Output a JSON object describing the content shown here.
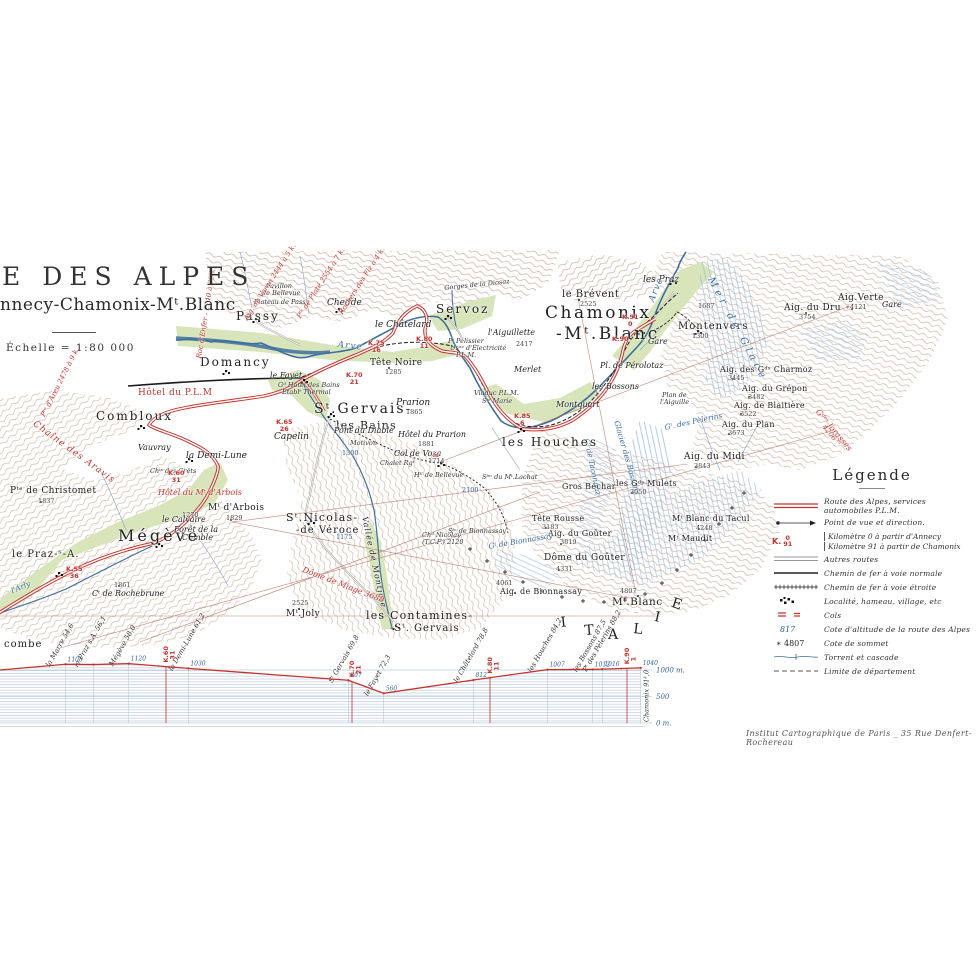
{
  "title": {
    "main": "E DES ALPES",
    "sub": "nnecy-Chamonix-Mᵗ.Blanc",
    "scale": "Échelle = 1:80 000"
  },
  "credit": "Institut Cartographique de Paris _ 35 Rue Denfert-Rochereau",
  "colors": {
    "route_red": "#c5332d",
    "water_blue": "#3f6f9f",
    "alt_blue": "#34629c",
    "terrain_brown": "#ad7a5c"
  },
  "legend": {
    "title": "Légende",
    "items": [
      {
        "sym": "route",
        "label": "Route des Alpes, services automobiles P.L.M."
      },
      {
        "sym": "view",
        "label": "Point de vue et direction."
      },
      {
        "sym": "km",
        "sym_top": "K.",
        "sym_num": "0",
        "sym_den": "91",
        "lines": [
          "Kilomètre 0 à partir d'Annecy",
          "Kilomètre 91 à partir de Chamonix"
        ]
      },
      {
        "sym": "road",
        "label": "Autres routes"
      },
      {
        "sym": "rail",
        "label": "Chemin de fer à voie normale"
      },
      {
        "sym": "railn",
        "label": "Chemin de fer à voie étroite"
      },
      {
        "sym": "loc",
        "label": "Localité, hameau, village, etc"
      },
      {
        "sym": "col",
        "label": "Cols"
      },
      {
        "sym": "alt",
        "sym_text": "817",
        "label": "Cote d'altitude de la route des Alpes"
      },
      {
        "sym": "summit",
        "sym_text": "4807",
        "label": "Cote de sommet"
      },
      {
        "sym": "torrent",
        "label": "Torrent et cascade"
      },
      {
        "sym": "limit",
        "label": "Limite de département"
      }
    ]
  },
  "chart_data": {
    "type": "line",
    "title": "",
    "ylabel": "m",
    "ylim": [
      0,
      1200
    ],
    "yticks": [
      {
        "label": "1000 m.",
        "value": 1000
      },
      {
        "label": "500",
        "value": 500
      },
      {
        "label": "0 m.",
        "value": 0
      }
    ],
    "stations": [
      {
        "name": "la Marre",
        "km_label": "54,6",
        "km": 54.6,
        "elev": 1108,
        "elev_label": "1108"
      },
      {
        "name": "le Praz s.A.",
        "km_label": "56,1",
        "km": 56.1,
        "elev": 1103,
        "elev_label": ""
      },
      {
        "name": "Mégève",
        "km_label": "58,0",
        "km": 58.0,
        "elev": 1120,
        "elev_label": "1120"
      },
      {
        "name": "la Demi-Lune",
        "km_label": "61,2",
        "km": 61.2,
        "elev": 1030,
        "elev_label": "1030"
      },
      {
        "name": "Sᵗ Gervais",
        "km_label": "69,8",
        "km": 69.8,
        "elev": 807,
        "elev_label": "807"
      },
      {
        "name": "le Fayet",
        "km_label": "72,3",
        "km": 72.3,
        "elev": 560,
        "elev_label": "560"
      },
      {
        "name": "le Châtelard",
        "km_label": "78,8",
        "km": 78.8,
        "elev": 812,
        "elev_label": "812"
      },
      {
        "name": "les Houches",
        "km_label": "84,2",
        "km": 84.2,
        "elev": 1007,
        "elev_label": "1007"
      },
      {
        "name": "les Bossons",
        "km_label": "87,5",
        "km": 87.5,
        "elev": 1012,
        "elev_label": "1012"
      },
      {
        "name": "Pᵗ des Pèlerins",
        "km_label": "88,2",
        "km": 88.2,
        "elev": 1016,
        "elev_label": "1016"
      },
      {
        "name": "Chamonix",
        "km_label": "91,0",
        "km": 91.0,
        "elev": 1040,
        "elev_label": "1040",
        "name_hidden": true
      }
    ],
    "km_markers": [
      {
        "label": "K.60",
        "sub": "31",
        "km": 60
      },
      {
        "label": "K.70",
        "sub": "21",
        "km": 70
      },
      {
        "label": "K.80",
        "sub": "11",
        "km": 80
      },
      {
        "label": "K.90",
        "sub": "1",
        "km": 90
      }
    ],
    "end_label": "Chamonix 91ᵏ,0"
  },
  "map": {
    "labels": [
      {
        "t": "Passy",
        "x": 236,
        "y": 310,
        "c": "town"
      },
      {
        "t": "Chedde",
        "x": 327,
        "y": 299,
        "c": "ham"
      },
      {
        "t": "le Châtelard",
        "x": 375,
        "y": 321,
        "c": "ham"
      },
      {
        "t": "Servoz",
        "x": 436,
        "y": 303,
        "c": "town"
      },
      {
        "t": "Tête Noire",
        "x": 370,
        "y": 359,
        "c": "peak9"
      },
      {
        "t": "1285",
        "x": 385,
        "y": 369,
        "c": "elev"
      },
      {
        "t": "le Brévent",
        "x": 562,
        "y": 290,
        "c": "peak10"
      },
      {
        "t": "2525",
        "x": 580,
        "y": 301,
        "c": "elev"
      },
      {
        "t": "Chamonix",
        "x": 545,
        "y": 305,
        "c": "town-xl"
      },
      {
        "t": "-Mᵗ.Blanc",
        "x": 556,
        "y": 326,
        "c": "town-xl"
      },
      {
        "t": "les Praz",
        "x": 643,
        "y": 276,
        "c": "ham"
      },
      {
        "t": "Gare",
        "x": 648,
        "y": 338,
        "c": "ham8"
      },
      {
        "t": "Montenvers",
        "x": 678,
        "y": 322,
        "c": "town10"
      },
      {
        "t": "1300",
        "x": 692,
        "y": 333,
        "c": "elev"
      },
      {
        "t": "1687",
        "x": 698,
        "y": 303,
        "c": "elev"
      },
      {
        "t": "Gare",
        "x": 882,
        "y": 301,
        "c": "ham8"
      },
      {
        "t": "Aig. du Dru",
        "x": 784,
        "y": 304,
        "c": "peak9"
      },
      {
        "t": "3754",
        "x": 799,
        "y": 314,
        "c": "elev"
      },
      {
        "t": "Aig.Verte",
        "x": 838,
        "y": 294,
        "c": "peak9"
      },
      {
        "t": "4121",
        "x": 850,
        "y": 304,
        "c": "elev"
      },
      {
        "t": "Mer de Glace",
        "x": 714,
        "y": 276,
        "c": "blue10",
        "r": 62
      },
      {
        "t": "Aig. des Gᵈˢ Charmoz",
        "x": 720,
        "y": 366,
        "c": "peak8"
      },
      {
        "t": "3445",
        "x": 728,
        "y": 375,
        "c": "elev"
      },
      {
        "t": "Aig. du Grépon",
        "x": 742,
        "y": 385,
        "c": "peak8"
      },
      {
        "t": "3482",
        "x": 748,
        "y": 394,
        "c": "elev"
      },
      {
        "t": "Aig. de Blaitière",
        "x": 734,
        "y": 402,
        "c": "peak8"
      },
      {
        "t": "3522",
        "x": 740,
        "y": 411,
        "c": "elev"
      },
      {
        "t": "Aig. du Plan",
        "x": 722,
        "y": 421,
        "c": "peak8"
      },
      {
        "t": "3673",
        "x": 728,
        "y": 430,
        "c": "elev"
      },
      {
        "t": "Aig. du Midi",
        "x": 684,
        "y": 453,
        "c": "peak9"
      },
      {
        "t": "3843",
        "x": 694,
        "y": 463,
        "c": "elev"
      },
      {
        "t": "Plan de",
        "x": 662,
        "y": 392,
        "c": "tiny"
      },
      {
        "t": "l'Aiguille",
        "x": 660,
        "y": 399,
        "c": "tiny"
      },
      {
        "t": "Gˡ. des Pèlerins",
        "x": 664,
        "y": 424,
        "c": "blue8",
        "r": -12
      },
      {
        "t": "Glacier des Bossons",
        "x": 620,
        "y": 420,
        "c": "blue8",
        "r": 74
      },
      {
        "t": "Gˡ de Taconnaz",
        "x": 590,
        "y": 438,
        "c": "blue8",
        "r": 78
      },
      {
        "t": "Gros Béchar",
        "x": 562,
        "y": 483,
        "c": "peak8"
      },
      {
        "t": "les Gᵈˢ Mulets",
        "x": 616,
        "y": 480,
        "c": "peak8"
      },
      {
        "t": "3050",
        "x": 630,
        "y": 489,
        "c": "elev"
      },
      {
        "t": "Tête Rousse",
        "x": 532,
        "y": 515,
        "c": "peak8"
      },
      {
        "t": "3183",
        "x": 542,
        "y": 524,
        "c": "elev"
      },
      {
        "t": "Aig. du Goûter",
        "x": 548,
        "y": 530,
        "c": "peak8"
      },
      {
        "t": "3819",
        "x": 560,
        "y": 539,
        "c": "elev"
      },
      {
        "t": "Mᵗ Blanc du Tacul",
        "x": 672,
        "y": 515,
        "c": "peak8"
      },
      {
        "t": "4248",
        "x": 696,
        "y": 525,
        "c": "elev"
      },
      {
        "t": "Mᵗ Maudit",
        "x": 668,
        "y": 535,
        "c": "peak8"
      },
      {
        "t": "Dôme du Goûter",
        "x": 544,
        "y": 554,
        "c": "peak9"
      },
      {
        "t": "4331",
        "x": 556,
        "y": 566,
        "c": "elev"
      },
      {
        "t": "4061",
        "x": 496,
        "y": 580,
        "c": "elev"
      },
      {
        "t": "Aig. de Bionnassay",
        "x": 500,
        "y": 588,
        "c": "peak8"
      },
      {
        "t": "Gˡ de Bionnassay",
        "x": 488,
        "y": 543,
        "c": "blue8",
        "r": -10
      },
      {
        "t": "4807",
        "x": 620,
        "y": 588,
        "c": "elev"
      },
      {
        "t": "Mᵗ.Blanc",
        "x": 612,
        "y": 597,
        "c": "peak11"
      },
      {
        "t": "Sᵗᵐ du Mᵗ.Lachat",
        "x": 482,
        "y": 474,
        "c": "tiny"
      },
      {
        "t": "2100",
        "x": 462,
        "y": 487,
        "c": "belev"
      },
      {
        "t": "Sᵗⁿ de Bionnassay",
        "x": 448,
        "y": 528,
        "c": "tiny"
      },
      {
        "t": "Chᵈ Nicolay",
        "x": 422,
        "y": 532,
        "c": "tiny"
      },
      {
        "t": "(T.C.F.) 2120",
        "x": 422,
        "y": 539,
        "c": "tiny"
      },
      {
        "t": "les Houches",
        "x": 502,
        "y": 436,
        "c": "town"
      },
      {
        "t": "Montquart",
        "x": 556,
        "y": 401,
        "c": "ham8"
      },
      {
        "t": "les Bossons",
        "x": 592,
        "y": 383,
        "c": "ham8"
      },
      {
        "t": "Pl. de Pérolotaz",
        "x": 600,
        "y": 362,
        "c": "ham8"
      },
      {
        "t": "Merlet",
        "x": 514,
        "y": 366,
        "c": "ham8"
      },
      {
        "t": "l'Aiguillette",
        "x": 488,
        "y": 329,
        "c": "ham8"
      },
      {
        "t": "2417",
        "x": 516,
        "y": 341,
        "c": "elev"
      },
      {
        "t": "Gorges de la Diosaz",
        "x": 444,
        "y": 285,
        "c": "tiny",
        "r": -6
      },
      {
        "t": "Pᵗ Pélissier",
        "x": 448,
        "y": 338,
        "c": "tiny"
      },
      {
        "t": "Usⁿᵉ d'Électricité",
        "x": 450,
        "y": 345,
        "c": "tiny"
      },
      {
        "t": "P.L.M.",
        "x": 456,
        "y": 352,
        "c": "tiny"
      },
      {
        "t": "Viaduc P.L.M.",
        "x": 474,
        "y": 390,
        "c": "tiny"
      },
      {
        "t": "Sᵗᵉ Marie",
        "x": 482,
        "y": 398,
        "c": "tiny"
      },
      {
        "t": "Plateau de Passy",
        "x": 254,
        "y": 299,
        "c": "tiny"
      },
      {
        "t": "Pavillon",
        "x": 266,
        "y": 283,
        "c": "tiny"
      },
      {
        "t": "de Bellevue",
        "x": 262,
        "y": 290,
        "c": "tiny"
      },
      {
        "t": "Arve",
        "x": 338,
        "y": 341,
        "c": "blue9",
        "r": 6
      },
      {
        "t": "Arve",
        "x": 648,
        "y": 300,
        "c": "blue9",
        "r": -68
      },
      {
        "t": "Domancy",
        "x": 200,
        "y": 356,
        "c": "town"
      },
      {
        "t": "Hôtel du P.L.M",
        "x": 138,
        "y": 389,
        "c": "redb"
      },
      {
        "t": "Combloux",
        "x": 96,
        "y": 410,
        "c": "town"
      },
      {
        "t": "Vauvray",
        "x": 138,
        "y": 444,
        "c": "ham8"
      },
      {
        "t": "la Demi-Lune",
        "x": 186,
        "y": 452,
        "c": "ham"
      },
      {
        "t": "Chᵗˢ des Crêts",
        "x": 150,
        "y": 468,
        "c": "tiny"
      },
      {
        "t": "le Fayet",
        "x": 270,
        "y": 372,
        "c": "ham8"
      },
      {
        "t": "Gᵈ Hôtel des Bains",
        "x": 278,
        "y": 382,
        "c": "tiny"
      },
      {
        "t": "Établᵗ Thermal",
        "x": 282,
        "y": 389,
        "c": "tiny"
      },
      {
        "t": "Sᵗ.Gervais-",
        "x": 314,
        "y": 402,
        "c": "town15"
      },
      {
        "t": "les Bains",
        "x": 336,
        "y": 420,
        "c": "town11"
      },
      {
        "t": "Capelin",
        "x": 274,
        "y": 433,
        "c": "ham"
      },
      {
        "t": "Pont du Diable",
        "x": 334,
        "y": 427,
        "c": "ham8"
      },
      {
        "t": "Motivon",
        "x": 350,
        "y": 440,
        "c": "tiny"
      },
      {
        "t": "1300",
        "x": 342,
        "y": 450,
        "c": "belev"
      },
      {
        "t": "Prarion",
        "x": 396,
        "y": 399,
        "c": "ham"
      },
      {
        "t": "1865",
        "x": 406,
        "y": 409,
        "c": "elev"
      },
      {
        "t": "Hôtel du Prarion",
        "x": 398,
        "y": 431,
        "c": "ham8"
      },
      {
        "t": "1881",
        "x": 418,
        "y": 441,
        "c": "elev"
      },
      {
        "t": "Col de Voza",
        "x": 394,
        "y": 450,
        "c": "ham8"
      },
      {
        "t": "1714",
        "x": 428,
        "y": 458,
        "c": "elev"
      },
      {
        "t": "Chalet Rgᵗ",
        "x": 380,
        "y": 460,
        "c": "tiny"
      },
      {
        "t": "Hᵗˡ de Bellevue",
        "x": 414,
        "y": 472,
        "c": "tiny"
      },
      {
        "t": "≍",
        "x": 432,
        "y": 452,
        "c": "col"
      },
      {
        "t": "Pᵗᵉ de Christomet",
        "x": 10,
        "y": 487,
        "c": "peak9"
      },
      {
        "t": "1837",
        "x": 38,
        "y": 498,
        "c": "elev"
      },
      {
        "t": "Hôtel du Mᵗ d'Arbois",
        "x": 158,
        "y": 489,
        "c": "red8"
      },
      {
        "t": "1270",
        "x": 182,
        "y": 512,
        "c": "elev"
      },
      {
        "t": "Mᵗ d'Arbois",
        "x": 208,
        "y": 504,
        "c": "peak9"
      },
      {
        "t": "1829",
        "x": 226,
        "y": 515,
        "c": "elev"
      },
      {
        "t": "le Calvaire",
        "x": 162,
        "y": 516,
        "c": "ham8"
      },
      {
        "t": "Forêt de la",
        "x": 174,
        "y": 526,
        "c": "ham8"
      },
      {
        "t": "Comble",
        "x": 182,
        "y": 534,
        "c": "ham8"
      },
      {
        "t": "Mégève",
        "x": 118,
        "y": 528,
        "c": "town-lg"
      },
      {
        "t": "le Praz-ˢ-A.",
        "x": 12,
        "y": 550,
        "c": "town10"
      },
      {
        "t": "1861",
        "x": 114,
        "y": 582,
        "c": "elev"
      },
      {
        "t": "Cᵗ de Rochebrune",
        "x": 92,
        "y": 590,
        "c": "ham8"
      },
      {
        "t": "Mᵗ.Joly",
        "x": 286,
        "y": 610,
        "c": "peak9"
      },
      {
        "t": "2525",
        "x": 292,
        "y": 600,
        "c": "elev"
      },
      {
        "t": "Sᵗ.Nicolas-",
        "x": 286,
        "y": 512,
        "c": "town11"
      },
      {
        "t": "-de Véroce",
        "x": 296,
        "y": 526,
        "c": "town10"
      },
      {
        "t": "1175",
        "x": 336,
        "y": 534,
        "c": "belev"
      },
      {
        "t": "Vallée de Montjoie",
        "x": 368,
        "y": 516,
        "c": "vall",
        "r": 78
      },
      {
        "t": "les Contamines-",
        "x": 366,
        "y": 610,
        "c": "town11"
      },
      {
        "t": "-Sᵗ. Gervais",
        "x": 390,
        "y": 624,
        "c": "town10"
      },
      {
        "t": "Dôme de Miage 3688",
        "x": 304,
        "y": 566,
        "c": "red8",
        "r": 21
      },
      {
        "t": "Chaîne des Aravis",
        "x": 36,
        "y": 420,
        "c": "red9",
        "r": 36
      },
      {
        "t": "Roc d'Enfer - 2240 à 33 k.",
        "x": 196,
        "y": 358,
        "c": "red7",
        "r": -81
      },
      {
        "t": "Pᵗᵉ d'Areu 2478 à 9 k.",
        "x": 40,
        "y": 415,
        "c": "red7",
        "r": -63
      },
      {
        "t": "Aig. de Varan 2444 à 5 k.",
        "x": 243,
        "y": 318,
        "c": "red7",
        "r": -57
      },
      {
        "t": "Pᵗᵉ de Platé 2554 à 7 k.",
        "x": 296,
        "y": 316,
        "c": "red7",
        "r": -57
      },
      {
        "t": "Rochers des Fiz à 4 k.",
        "x": 338,
        "y": 312,
        "c": "red7",
        "r": -57
      },
      {
        "t": "Gᵈᵉˢ Jorasses",
        "x": 820,
        "y": 408,
        "c": "red8",
        "r": 50
      },
      {
        "t": "4206 ᵐ",
        "x": 826,
        "y": 424,
        "c": "red7",
        "r": 50
      },
      {
        "t": "l'Arly",
        "x": 10,
        "y": 588,
        "c": "blue8",
        "r": -24
      },
      {
        "t": "combe",
        "x": 4,
        "y": 640,
        "c": "town10"
      },
      {
        "t": "I",
        "x": 560,
        "y": 616,
        "c": "italie",
        "r": -6
      },
      {
        "t": "T",
        "x": 584,
        "y": 624,
        "c": "italie",
        "r": -4
      },
      {
        "t": "A",
        "x": 608,
        "y": 628,
        "c": "italie"
      },
      {
        "t": "L",
        "x": 634,
        "y": 622,
        "c": "italie",
        "r": 6
      },
      {
        "t": "I",
        "x": 656,
        "y": 610,
        "c": "italie",
        "r": 12
      },
      {
        "t": "E",
        "x": 674,
        "y": 596,
        "c": "italie",
        "r": 18
      },
      {
        "t": "K.55|36",
        "x": 66,
        "y": 566,
        "c": "km"
      },
      {
        "t": "K.60|31",
        "x": 168,
        "y": 470,
        "c": "km"
      },
      {
        "t": "K.65|26",
        "x": 276,
        "y": 419,
        "c": "km"
      },
      {
        "t": "K.70|21",
        "x": 346,
        "y": 372,
        "c": "km"
      },
      {
        "t": "K.75|16",
        "x": 368,
        "y": 340,
        "c": "km"
      },
      {
        "t": "K.80|11",
        "x": 416,
        "y": 336,
        "c": "km"
      },
      {
        "t": "K.85|6",
        "x": 514,
        "y": 413,
        "c": "km"
      },
      {
        "t": "K.90",
        "x": 612,
        "y": 336,
        "c": "km"
      },
      {
        "t": "K.91|0",
        "x": 622,
        "y": 314,
        "c": "km"
      }
    ]
  }
}
